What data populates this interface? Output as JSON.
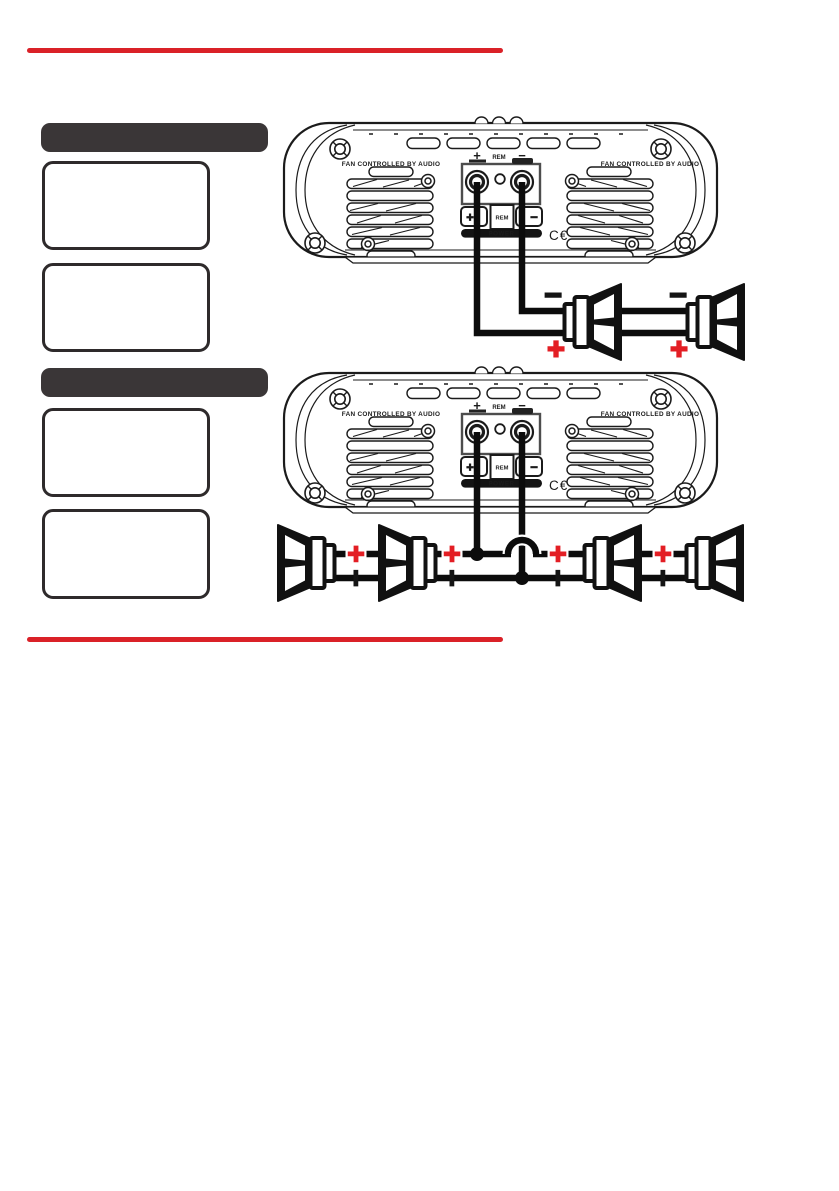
{
  "page": {
    "width": 839,
    "height": 1191,
    "background": "#ffffff"
  },
  "colors": {
    "divider_red": "#da2128",
    "polarity_red": "#e31e24",
    "ink_black": "#1b1b1b",
    "header_pill_dark": "#3a3637"
  },
  "sidebar": {
    "sections": [
      {
        "header_text": "",
        "note_boxes": [
          "",
          ""
        ]
      },
      {
        "header_text": "",
        "note_boxes": [
          "",
          ""
        ]
      }
    ]
  },
  "amplifier": {
    "fan_label_left": "FAN CONTROLLED BY AUDIO",
    "fan_label_right": "FAN CONTROLLED BY AUDIO",
    "terminal_labels": {
      "plus": "+",
      "rem": "REM",
      "minus": "−"
    },
    "connector_labels": {
      "plus": "+",
      "rem": "REM",
      "minus": "−"
    },
    "power_label": "POWER",
    "ce_mark": "C€"
  },
  "diagram_series": {
    "speaker_count": 2,
    "plus_label": "+",
    "minus_label": "−"
  },
  "diagram_parallel": {
    "speaker_count": 4,
    "plus_label": "+",
    "minus_label": "−"
  }
}
